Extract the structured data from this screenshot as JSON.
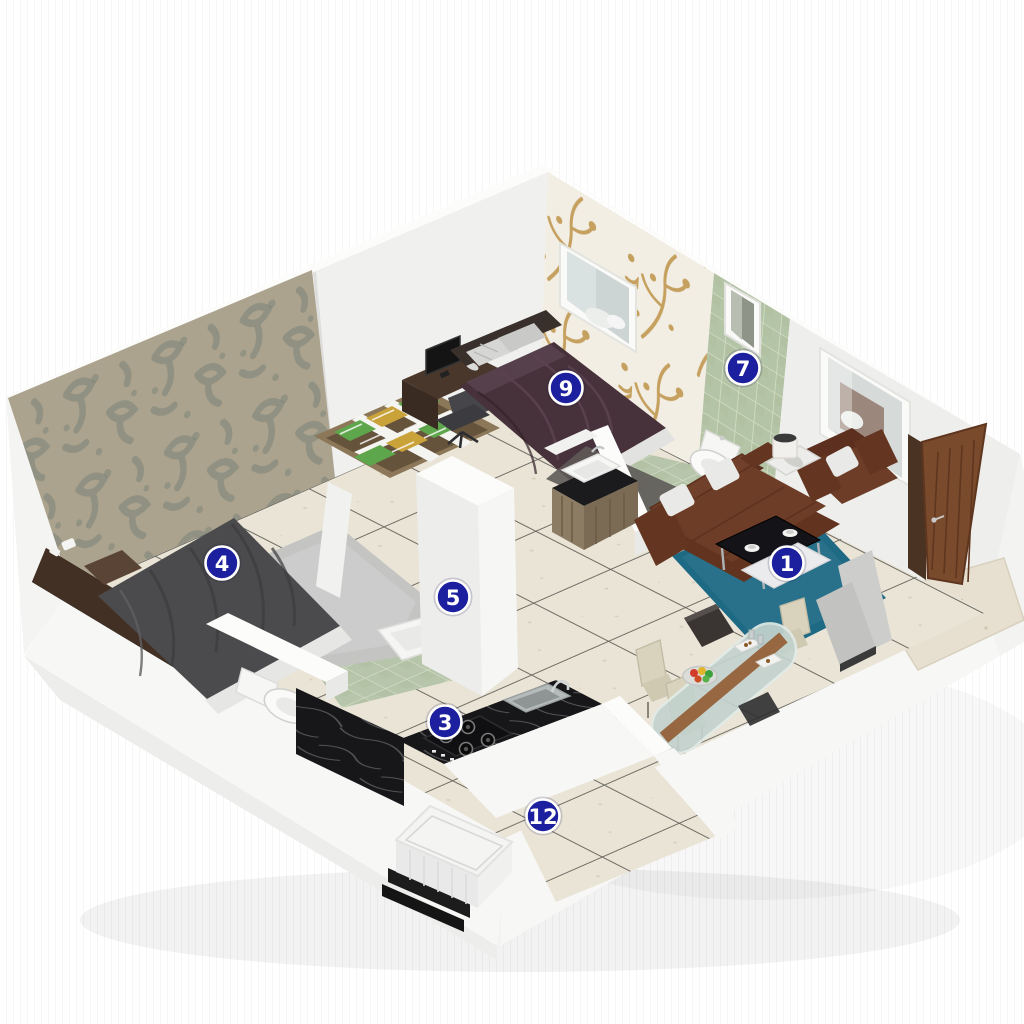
{
  "scene": {
    "kind": "3d-isometric-floorplan-cutaway",
    "background": "#ffffff"
  },
  "markers": [
    {
      "label": "1",
      "area": "living-area"
    },
    {
      "label": "3",
      "area": "kitchen"
    },
    {
      "label": "4",
      "area": "bedroom-2"
    },
    {
      "label": "5",
      "area": "bathroom-2"
    },
    {
      "label": "7",
      "area": "bathroom-1"
    },
    {
      "label": "9",
      "area": "bedroom-1"
    },
    {
      "label": "12",
      "area": "utility"
    }
  ],
  "marker_style": {
    "fill": "#1c1f9e",
    "ring": "#ffffff",
    "text_color": "#ffffff"
  },
  "palette": {
    "floor_tile": "#eae4d7",
    "grout": "#68665e",
    "bath_tile": "#b7c6aa",
    "bath_grout": "#d8e1cd",
    "wall_white": "#f1f1ef",
    "wallpaper_damask_base": "#a69c86",
    "wallpaper_damask_motif": "#6f7a6e",
    "wallpaper_branch_base": "#f2eee4",
    "wallpaper_branch_motif": "#c5a05e",
    "sofa_brown": "#6e3d28",
    "cushion_white": "#e9e9e7",
    "rug_teal": "#1e6a85",
    "rug_silver": "#c4c4c2",
    "rug_charcoal": "#5e5a57",
    "bed1_duvet": "#47313a",
    "bed2_duvet": "#4b4b4d",
    "wood_dark": "#4a372c",
    "wood_door": "#7a4a2c",
    "counter_marble": "#17171a",
    "clothes_green": "#5da64b",
    "clothes_yellow": "#c9a23a",
    "dining_chair": "#d9d3bd",
    "glass_table": "#c3d2ce",
    "washer_white": "#f4f4f3"
  }
}
